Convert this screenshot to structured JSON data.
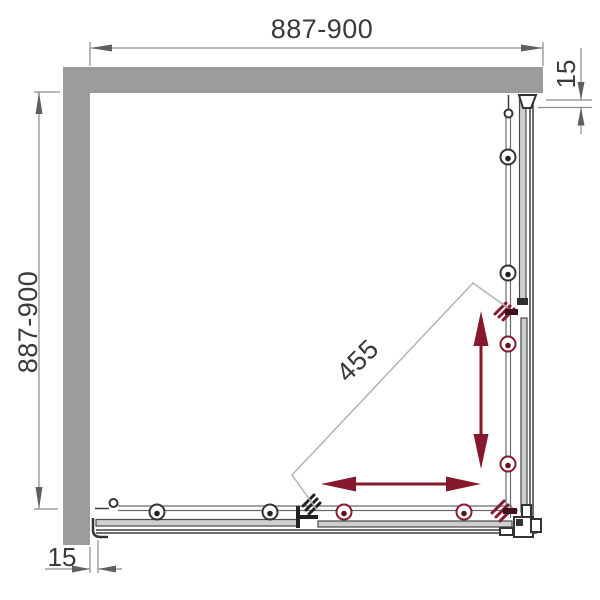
{
  "diagram": {
    "type": "technical-drawing",
    "subject": "corner shower enclosure plan view",
    "dimensions": {
      "top_width": "887-900",
      "left_depth": "887-900",
      "right_wall_profile": "15",
      "bottom_wall_profile": "15",
      "diagonal_entry": "455"
    },
    "colors": {
      "wall_gray": "#9c9c9c",
      "rail_line": "#3f3f3f",
      "dimension_line": "#8a8a8a",
      "dimension_text": "#3a3a3a",
      "accent_red": "#86192b",
      "glass_fill": "#cfcfcf",
      "background": "#ffffff"
    },
    "icons": {
      "roller": "double-circle-with-dot",
      "direction_arrow": "double-headed-slender-arrow",
      "door_edge": "hatched-bracket",
      "wall_hook": "j-profile-bracket"
    }
  }
}
